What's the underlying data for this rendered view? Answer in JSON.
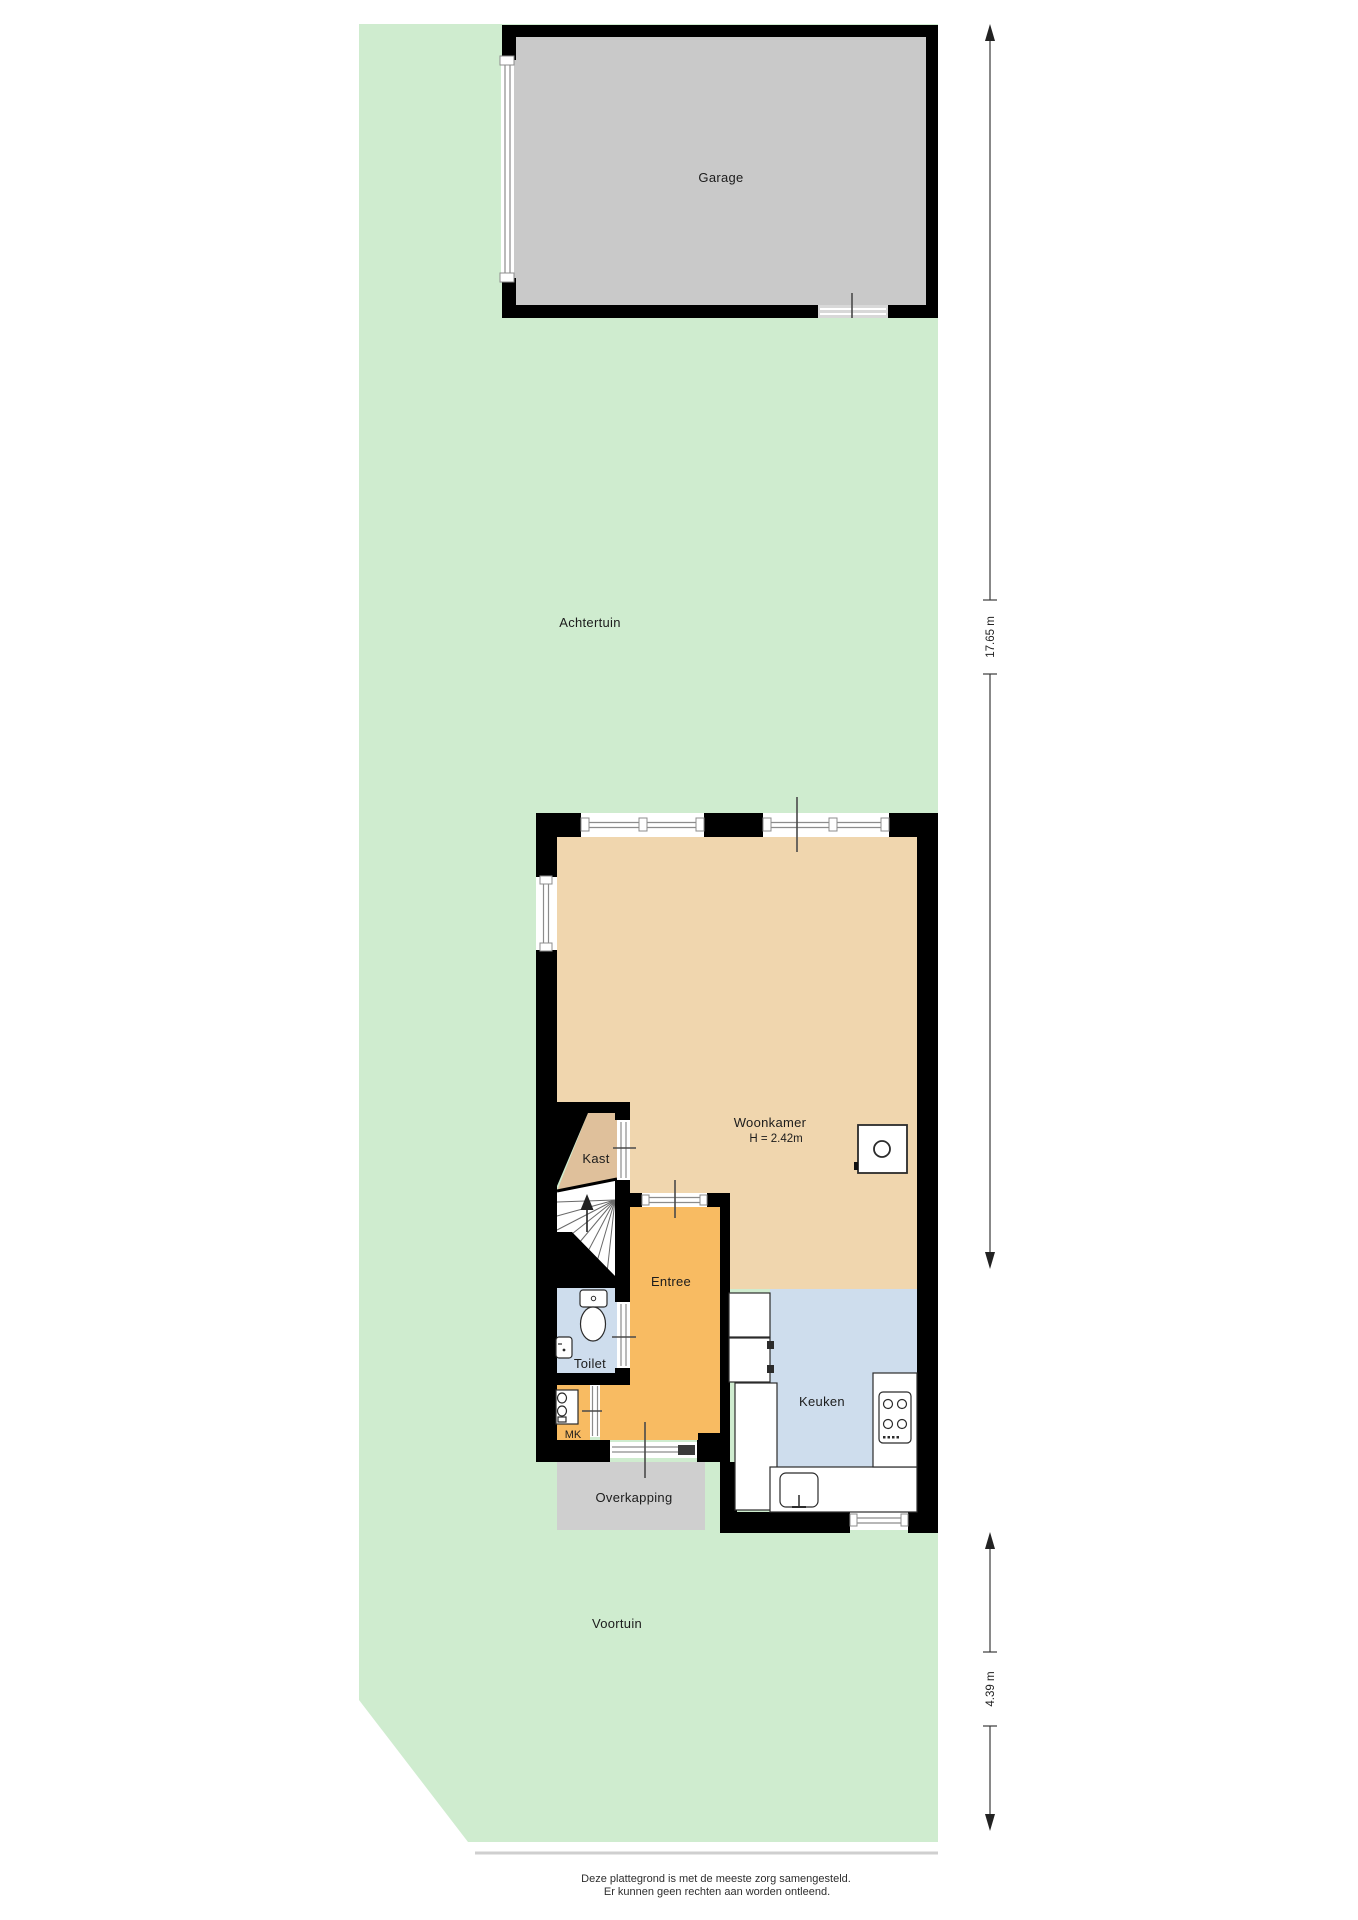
{
  "labels": {
    "garage": "Garage",
    "achtertuin": "Achtertuin",
    "woonkamer": "Woonkamer",
    "woonkamer_height": "H = 2.42m",
    "kast": "Kast",
    "entree": "Entree",
    "toilet": "Toilet",
    "mk": "MK",
    "keuken": "Keuken",
    "overkapping": "Overkapping",
    "voortuin": "Voortuin"
  },
  "dimensions": {
    "garden_back": "17.65 m",
    "garden_front": "4.39 m"
  },
  "footer": {
    "line1": "Deze plattegrond is met de meeste zorg samengesteld.",
    "line2": "Er kunnen geen rechten aan worden ontleend."
  },
  "colors": {
    "garden_green": "#cfeccf",
    "garage_gray": "#c9c9c9",
    "overkapping_gray": "#cfcfcf",
    "woonkamer_beige": "#f0d6ae",
    "kast_tan": "#dfc09b",
    "entree_orange": "#f8bb62",
    "wet_room_blue": "#cedded",
    "wall_black": "#000000",
    "plot_edge_gray": "#cfcfcf"
  }
}
